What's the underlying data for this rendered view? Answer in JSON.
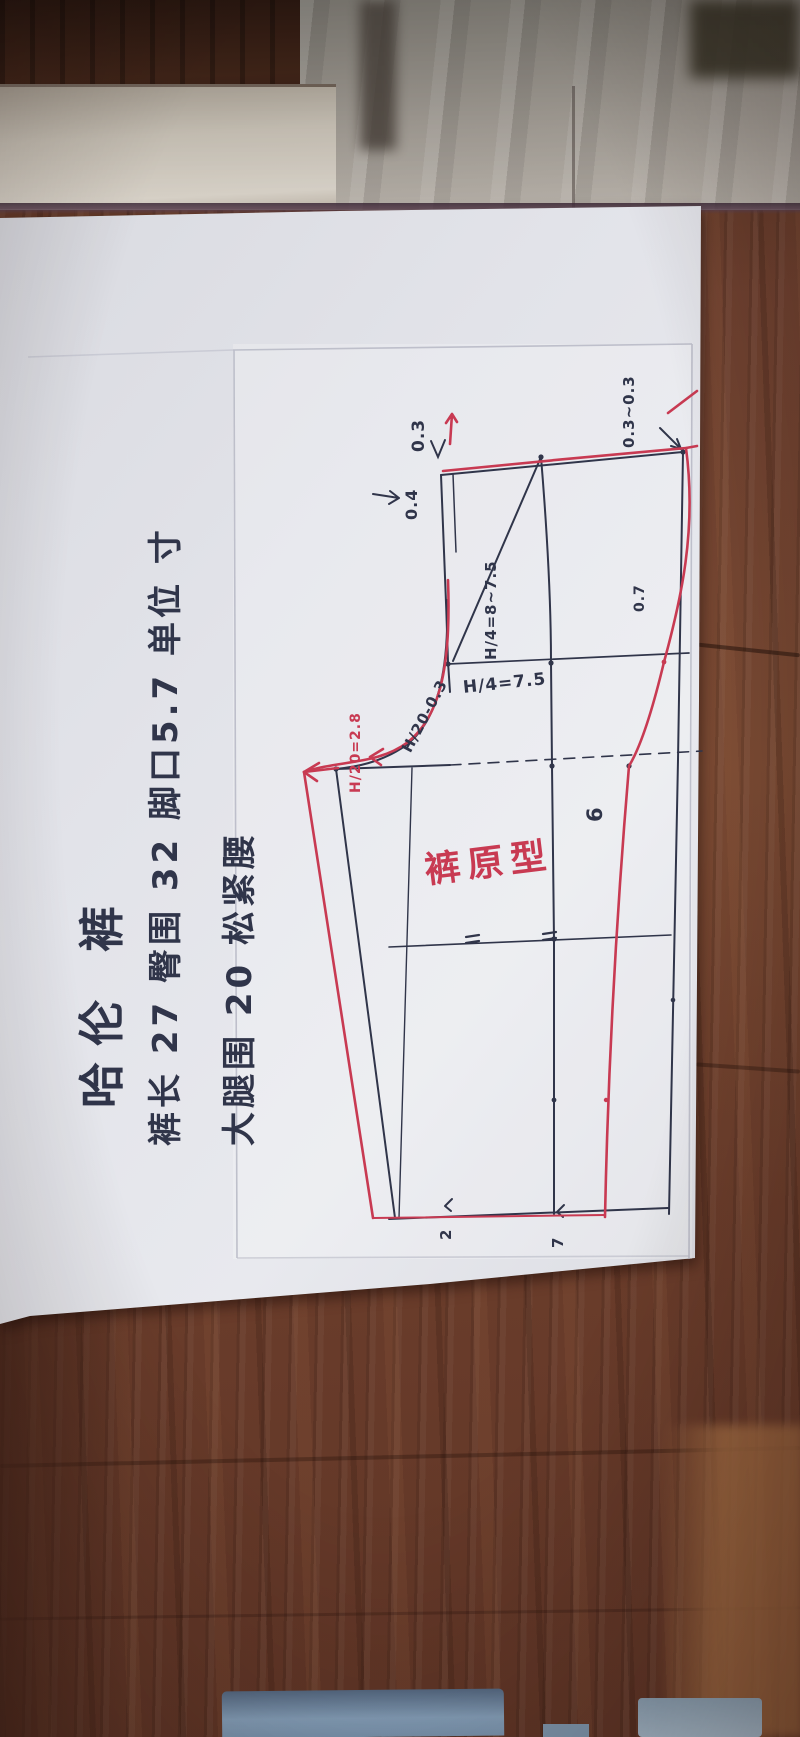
{
  "notes": {
    "title": "哈伦 裤",
    "specs1": "裤长 27  臀围 32  脚口5.7  单位 寸",
    "specs2": "大腿围 20  松紧腰"
  },
  "pattern": {
    "title": "裤原型",
    "annotations": [
      {
        "id": "waist-front-drop",
        "text": "0.3",
        "color": "black"
      },
      {
        "id": "waist-front-offset",
        "text": "0.4",
        "color": "black"
      },
      {
        "id": "waist-side-raise",
        "text": "0.3~0.3",
        "color": "black"
      },
      {
        "id": "hip-quarter-range",
        "text": "H/4=8~7.5",
        "color": "black"
      },
      {
        "id": "hip-width",
        "text": "H/4=7.5",
        "color": "black"
      },
      {
        "id": "front-crotch-width",
        "text": "H/20-0.3",
        "color": "black"
      },
      {
        "id": "back-crotch-width",
        "text": "H/20=2.8",
        "color": "red"
      },
      {
        "id": "side-seam-ease",
        "text": "0.7",
        "color": "black"
      },
      {
        "id": "leg-measure",
        "text": "6",
        "color": "black"
      },
      {
        "id": "hem-mark-left",
        "text": "2",
        "color": "black"
      },
      {
        "id": "hem-mark-right",
        "text": "7",
        "color": "black"
      }
    ]
  },
  "colors": {
    "wood": "#6f4130",
    "paper": "#e2e3e9",
    "ink": "#30354a",
    "red_pen": "#c83a52",
    "plastic": "#a8a29a",
    "blue_object": "#85a0ba"
  }
}
